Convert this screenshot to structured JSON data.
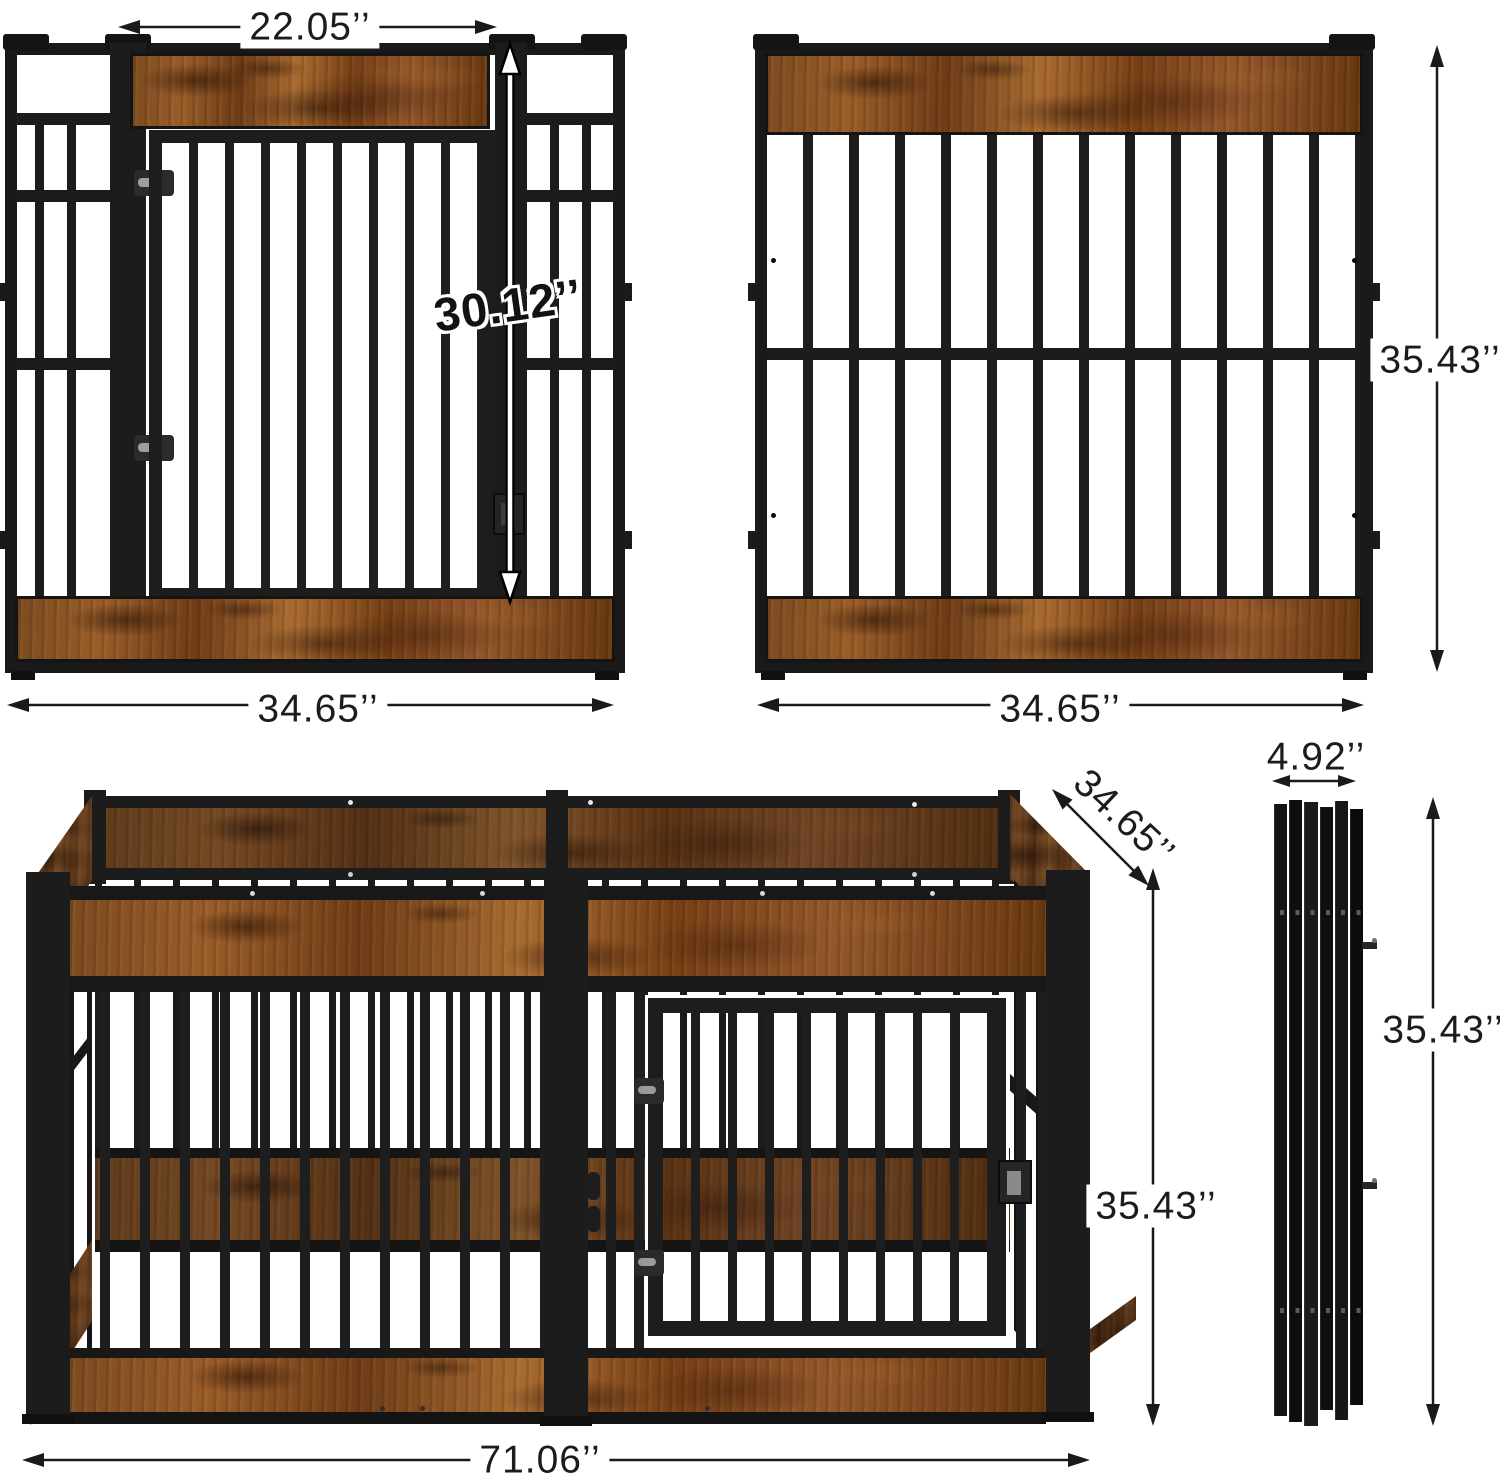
{
  "diagram": {
    "views": {
      "front_panel": {
        "gate_width": "22.05’’",
        "gate_height": "30.12’’",
        "panel_width": "34.65’’"
      },
      "side_panel": {
        "panel_height": "35.43’’",
        "panel_width": "34.65’’"
      },
      "assembled_pen": {
        "depth": "34.65’’",
        "height": "35.43’’",
        "length": "71.06’’"
      },
      "folded_stack": {
        "thickness": "4.92’’",
        "height": "35.43’’"
      }
    },
    "colors": {
      "metal_black": "#1c1c1c",
      "rustic_wood": "#8a4e22",
      "dimension_ink": "#1a1a1a",
      "background": "#ffffff",
      "gate_highlight": "#ffffff"
    }
  }
}
